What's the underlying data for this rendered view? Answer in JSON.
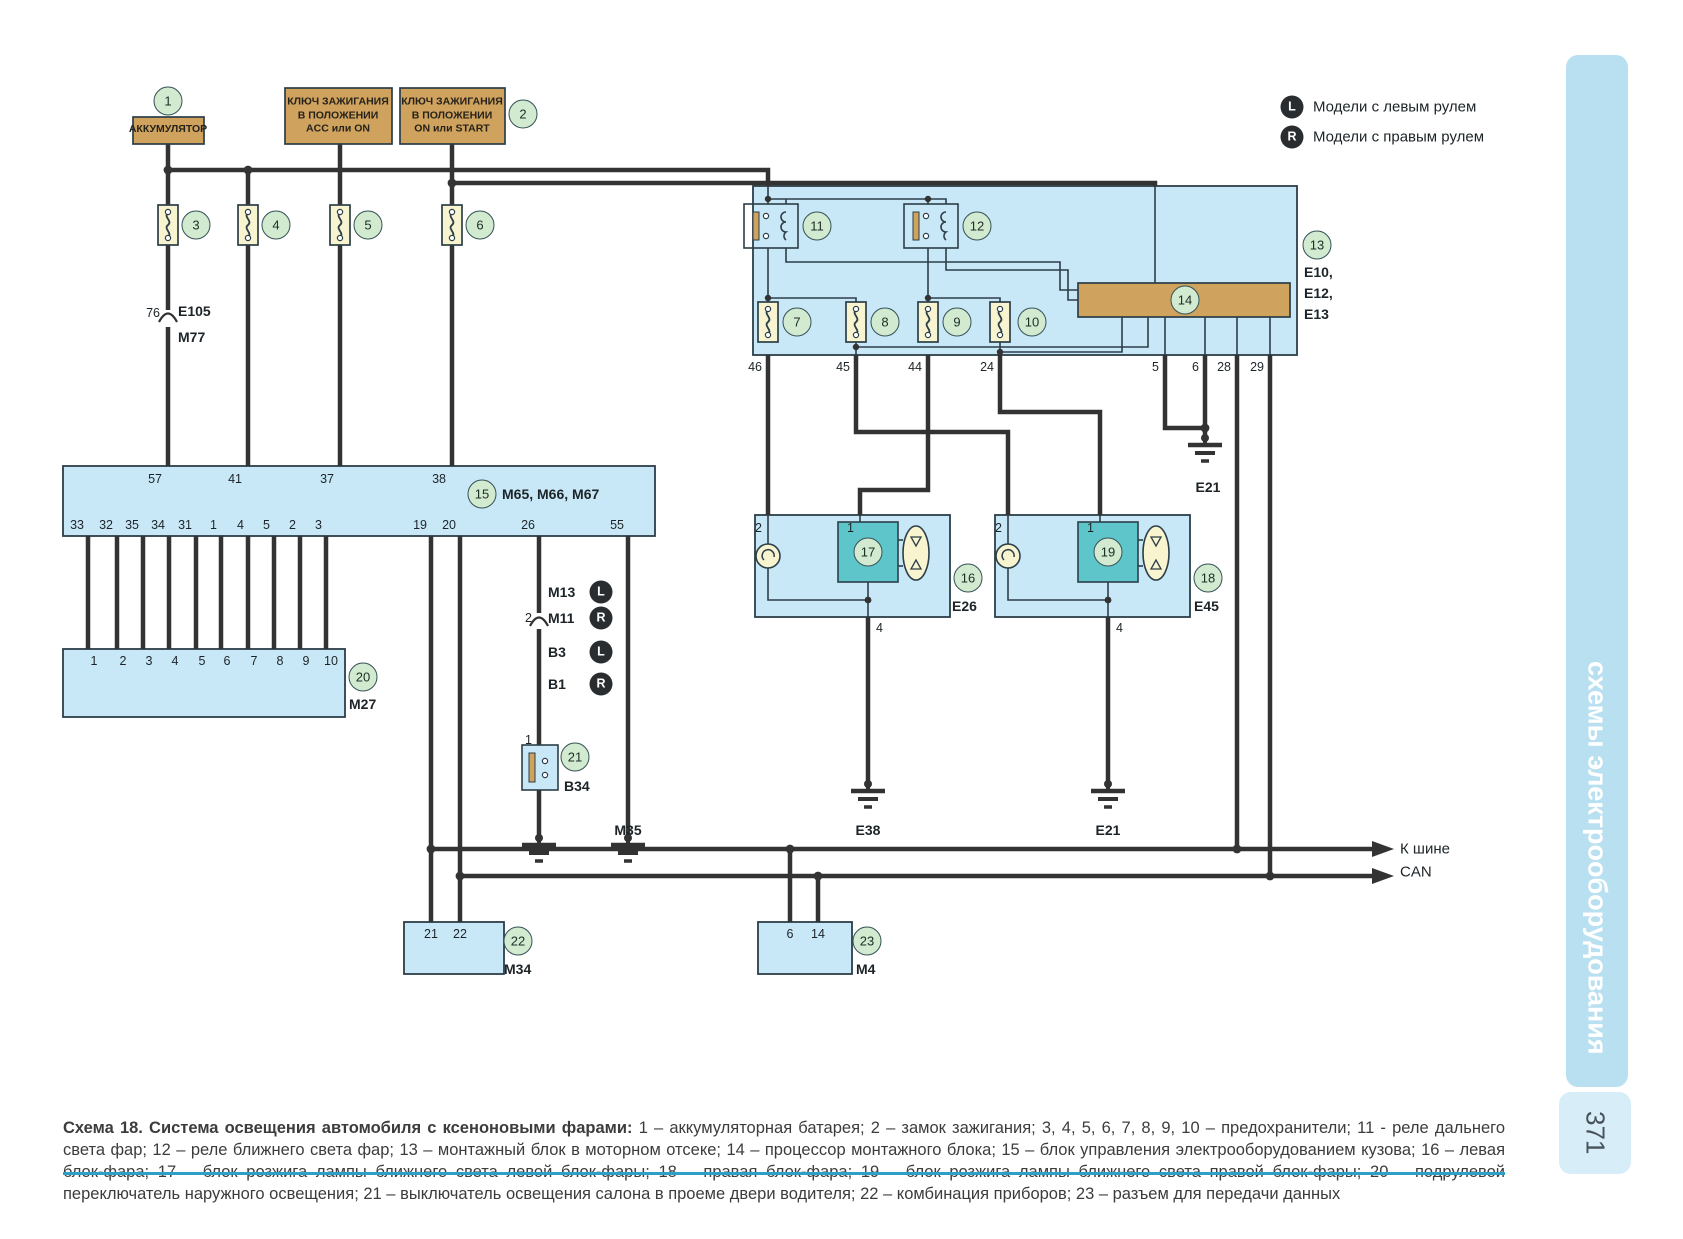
{
  "page": {
    "number": "371",
    "sidebar_title": "схемы электрооборудования"
  },
  "legend": {
    "l_badge": "L",
    "l_text": "Модели с левым рулем",
    "r_badge": "R",
    "r_text": "Модели с правым рулем"
  },
  "power": {
    "battery": "АККУМУЛЯТОР",
    "key_acc": "КЛЮЧ ЗАЖИГАНИЯ\nВ ПОЛОЖЕНИИ\nACC или ON",
    "key_on": "КЛЮЧ ЗАЖИГАНИЯ\nВ ПОЛОЖЕНИИ\nON или START"
  },
  "refs": {
    "r1": "1",
    "r2": "2",
    "r3": "3",
    "r4": "4",
    "r5": "5",
    "r6": "6",
    "r7": "7",
    "r8": "8",
    "r9": "9",
    "r10": "10",
    "r11": "11",
    "r12": "12",
    "r13": "13",
    "r14": "14",
    "r15": "15",
    "r16": "16",
    "r17": "17",
    "r18": "18",
    "r19": "19",
    "r20": "20",
    "r21": "21",
    "r22": "22",
    "r23": "23"
  },
  "labels": {
    "pin76": "76",
    "e105": "Е105",
    "m77": "М77",
    "m65": "М65, М66, М67",
    "m27": "М27",
    "m13": "М13",
    "m11": "М11",
    "b3": "В3",
    "b1": "В1",
    "b34": "В34",
    "conn2": "2",
    "b34pin": "1",
    "m35": "М35",
    "e26": "Е26",
    "e45": "Е45",
    "e38": "Е38",
    "e21_top": "Е21",
    "e21_right": "Е21",
    "e10": "Е10,",
    "e12": "Е12,",
    "e13": "Е13",
    "m34": "М34",
    "m4": "М4",
    "can1": "К шине",
    "can2": "CAN"
  },
  "pins": {
    "b13_bottom": [
      "46",
      "45",
      "44",
      "24",
      "5",
      "6",
      "28",
      "29"
    ],
    "b15_top": [
      "57",
      "41",
      "37",
      "38"
    ],
    "b15_bottom": [
      "33",
      "32",
      "35",
      "34",
      "31",
      "1",
      "4",
      "5",
      "2",
      "3",
      "19",
      "20",
      "26",
      "55"
    ],
    "m27_top": [
      "1",
      "2",
      "3",
      "4",
      "5",
      "6",
      "7",
      "8",
      "9",
      "10"
    ],
    "hl_left": {
      "p2": "2",
      "p1": "1",
      "p4": "4"
    },
    "hl_right": {
      "p2": "2",
      "p1": "1",
      "p4": "4"
    },
    "m34": [
      "21",
      "22"
    ],
    "m4": [
      "6",
      "14"
    ]
  },
  "caption": {
    "title": "Схема 18. Система освещения автомобиля с ксеноновыми фарами:",
    "body": "1 – аккумуляторная батарея; 2 – замок зажигания; 3, 4, 5, 6, 7, 8, 9, 10 – предохранители; 11 - реле дальнего света фар; 12 – реле ближнего света фар; 13 – монтажный блок в моторном отсеке; 14 – процессор монтажного блока; 15 – блок управления электрооборудованием кузова; 16 – левая блок-фара; 17 – блок розжига лампы ближнего света левой блок-фары; 18 – правая блок-фара; 19 – блок розжига лампы ближнего света правой блок-фары; 20 – подрулевой переключатель наружного освещения; 21 – выключатель освещения салона в проеме двери водителя; 22 – комбинация приборов; 23 – разъем для передачи данных"
  },
  "colors": {
    "box_blue": "#c9e8f7",
    "tan": "#cfa25e",
    "fuse_yellow": "#f8f4d0",
    "ref_green": "#d2ead0",
    "teal": "#5ec6cb",
    "wire": "#333333",
    "sidebar_band": "#b9e0f1",
    "rule": "#2f9fc5"
  }
}
